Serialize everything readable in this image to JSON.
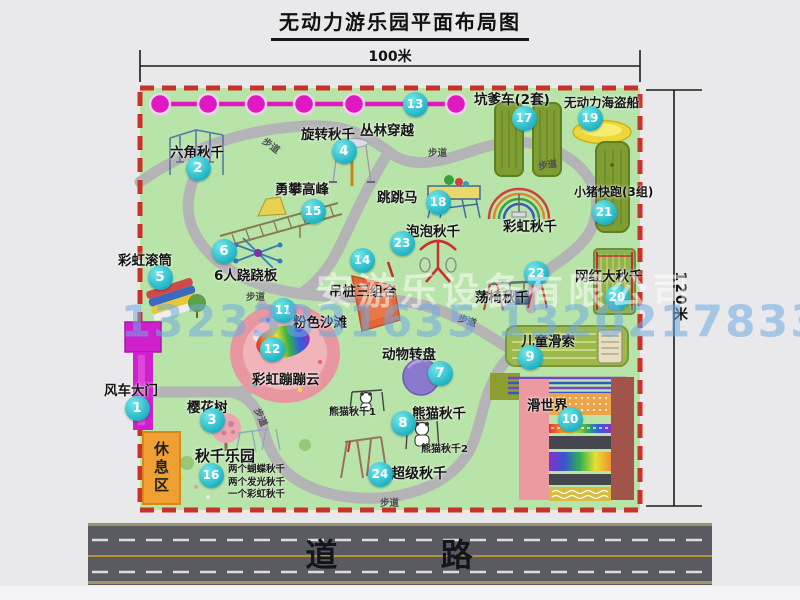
{
  "title": "无动力游乐园平面布局图",
  "dimensions": {
    "width": "100米",
    "height": "120米"
  },
  "road": {
    "label": "道 路"
  },
  "watermark": {
    "company": "安游乐设备有限公司",
    "phone": "13233831635 13202178333"
  },
  "rest_area_label": "休息区",
  "trail_label": "步道",
  "colors": {
    "park_green": "#b9e4a9",
    "border_red": "#c83228",
    "badge_teal": "#1fb2c4",
    "zipline_magenta": "#e018c0",
    "gate_magenta": "#cf1fcf",
    "road_gray": "#5a5a62",
    "rest_orange": "#f0a032"
  },
  "items": [
    {
      "num": "1",
      "label": "风车大门",
      "badge": [
        137,
        408
      ],
      "label_pos": [
        104,
        379
      ]
    },
    {
      "num": "2",
      "label": "六角秋千",
      "badge": [
        198,
        168
      ],
      "label_pos": [
        170,
        141
      ]
    },
    {
      "num": "3",
      "label": "樱花树",
      "badge": [
        212,
        420
      ],
      "label_pos": [
        187,
        396
      ]
    },
    {
      "num": "4",
      "label": "旋转秋千",
      "badge": [
        344,
        151
      ],
      "label_pos": [
        301,
        123
      ]
    },
    {
      "num": "5",
      "label": "彩虹滚筒",
      "badge": [
        160,
        277
      ],
      "label_pos": [
        118,
        249
      ]
    },
    {
      "num": "6",
      "label": "6人跷跷板",
      "badge": [
        224,
        251
      ],
      "label_pos": [
        214,
        264
      ]
    },
    {
      "num": "7",
      "label": "动物转盘",
      "badge": [
        440,
        373
      ],
      "label_pos": [
        382,
        343
      ]
    },
    {
      "num": "8",
      "label": "熊猫秋千",
      "badge": [
        403,
        423
      ],
      "label_pos": [
        412,
        402
      ]
    },
    {
      "num": "9",
      "label": "儿童滑索",
      "badge": [
        530,
        357
      ],
      "label_pos": [
        521,
        330
      ]
    },
    {
      "num": "10",
      "label": "滑世界",
      "badge": [
        570,
        419
      ],
      "label_pos": [
        527,
        394
      ]
    },
    {
      "num": "11",
      "label": "粉色沙滩",
      "badge": [
        283,
        310
      ],
      "label_pos": [
        293,
        311
      ]
    },
    {
      "num": "12",
      "label": "彩虹蹦蹦云",
      "badge": [
        272,
        349
      ],
      "label_pos": [
        252,
        368
      ]
    },
    {
      "num": "13",
      "label": "丛林穿越",
      "badge": [
        415,
        104
      ],
      "label_pos": [
        360,
        119
      ]
    },
    {
      "num": "14",
      "label": "吊桩三组合",
      "badge": [
        362,
        260
      ],
      "label_pos": [
        329,
        280
      ]
    },
    {
      "num": "15",
      "label": "勇攀高峰",
      "badge": [
        313,
        211
      ],
      "label_pos": [
        275,
        178
      ]
    },
    {
      "num": "16",
      "label": "秋千乐园",
      "badge": [
        211,
        475
      ],
      "label_pos": [
        195,
        445
      ],
      "fs": 15,
      "sub": [
        "两个蝴蝶秋千",
        "两个发光秋千",
        "一个彩虹秋千"
      ],
      "sub_pos": [
        228,
        461
      ]
    },
    {
      "num": "17",
      "label": "坑爹车(2套)",
      "badge": [
        524,
        118
      ],
      "label_pos": [
        474,
        88
      ]
    },
    {
      "num": "18",
      "label": "跳跳马",
      "badge": [
        438,
        202
      ],
      "label_pos": [
        377,
        186
      ]
    },
    {
      "num": "19",
      "label": "无动力海盗船",
      "badge": [
        590,
        118
      ],
      "label_pos": [
        564,
        92
      ],
      "fs": 12.5
    },
    {
      "num": "20",
      "label": "网红大秋千",
      "badge": [
        617,
        297
      ],
      "label_pos": [
        575,
        265
      ]
    },
    {
      "num": "21",
      "label": "小猪快跑(3组)",
      "badge": [
        604,
        212
      ],
      "label_pos": [
        574,
        183
      ],
      "fs": 12
    },
    {
      "num": "22",
      "label": "荡椅秋千",
      "badge": [
        536,
        273
      ],
      "label_pos": [
        475,
        286
      ]
    },
    {
      "num": "23",
      "label": "泡泡秋千",
      "badge": [
        402,
        243
      ],
      "label_pos": [
        406,
        220
      ]
    },
    {
      "num": "24",
      "label": "超级秋千",
      "badge": [
        380,
        474
      ],
      "label_pos": [
        391,
        463
      ],
      "fs": 14
    },
    {
      "label": "彩虹秋千",
      "label_pos": [
        503,
        215
      ]
    }
  ],
  "minor_labels": [
    {
      "text": "熊猫秋千1",
      "x": 329,
      "y": 403
    },
    {
      "text": "熊猫秋千2",
      "x": 421,
      "y": 440
    }
  ],
  "trail_positions": [
    {
      "x": 262,
      "y": 138,
      "r": 36
    },
    {
      "x": 428,
      "y": 145,
      "r": 0
    },
    {
      "x": 538,
      "y": 157,
      "r": -10
    },
    {
      "x": 246,
      "y": 289,
      "r": 0
    },
    {
      "x": 458,
      "y": 313,
      "r": 18
    },
    {
      "x": 252,
      "y": 410,
      "r": 66
    },
    {
      "x": 380,
      "y": 495,
      "r": 0
    }
  ]
}
